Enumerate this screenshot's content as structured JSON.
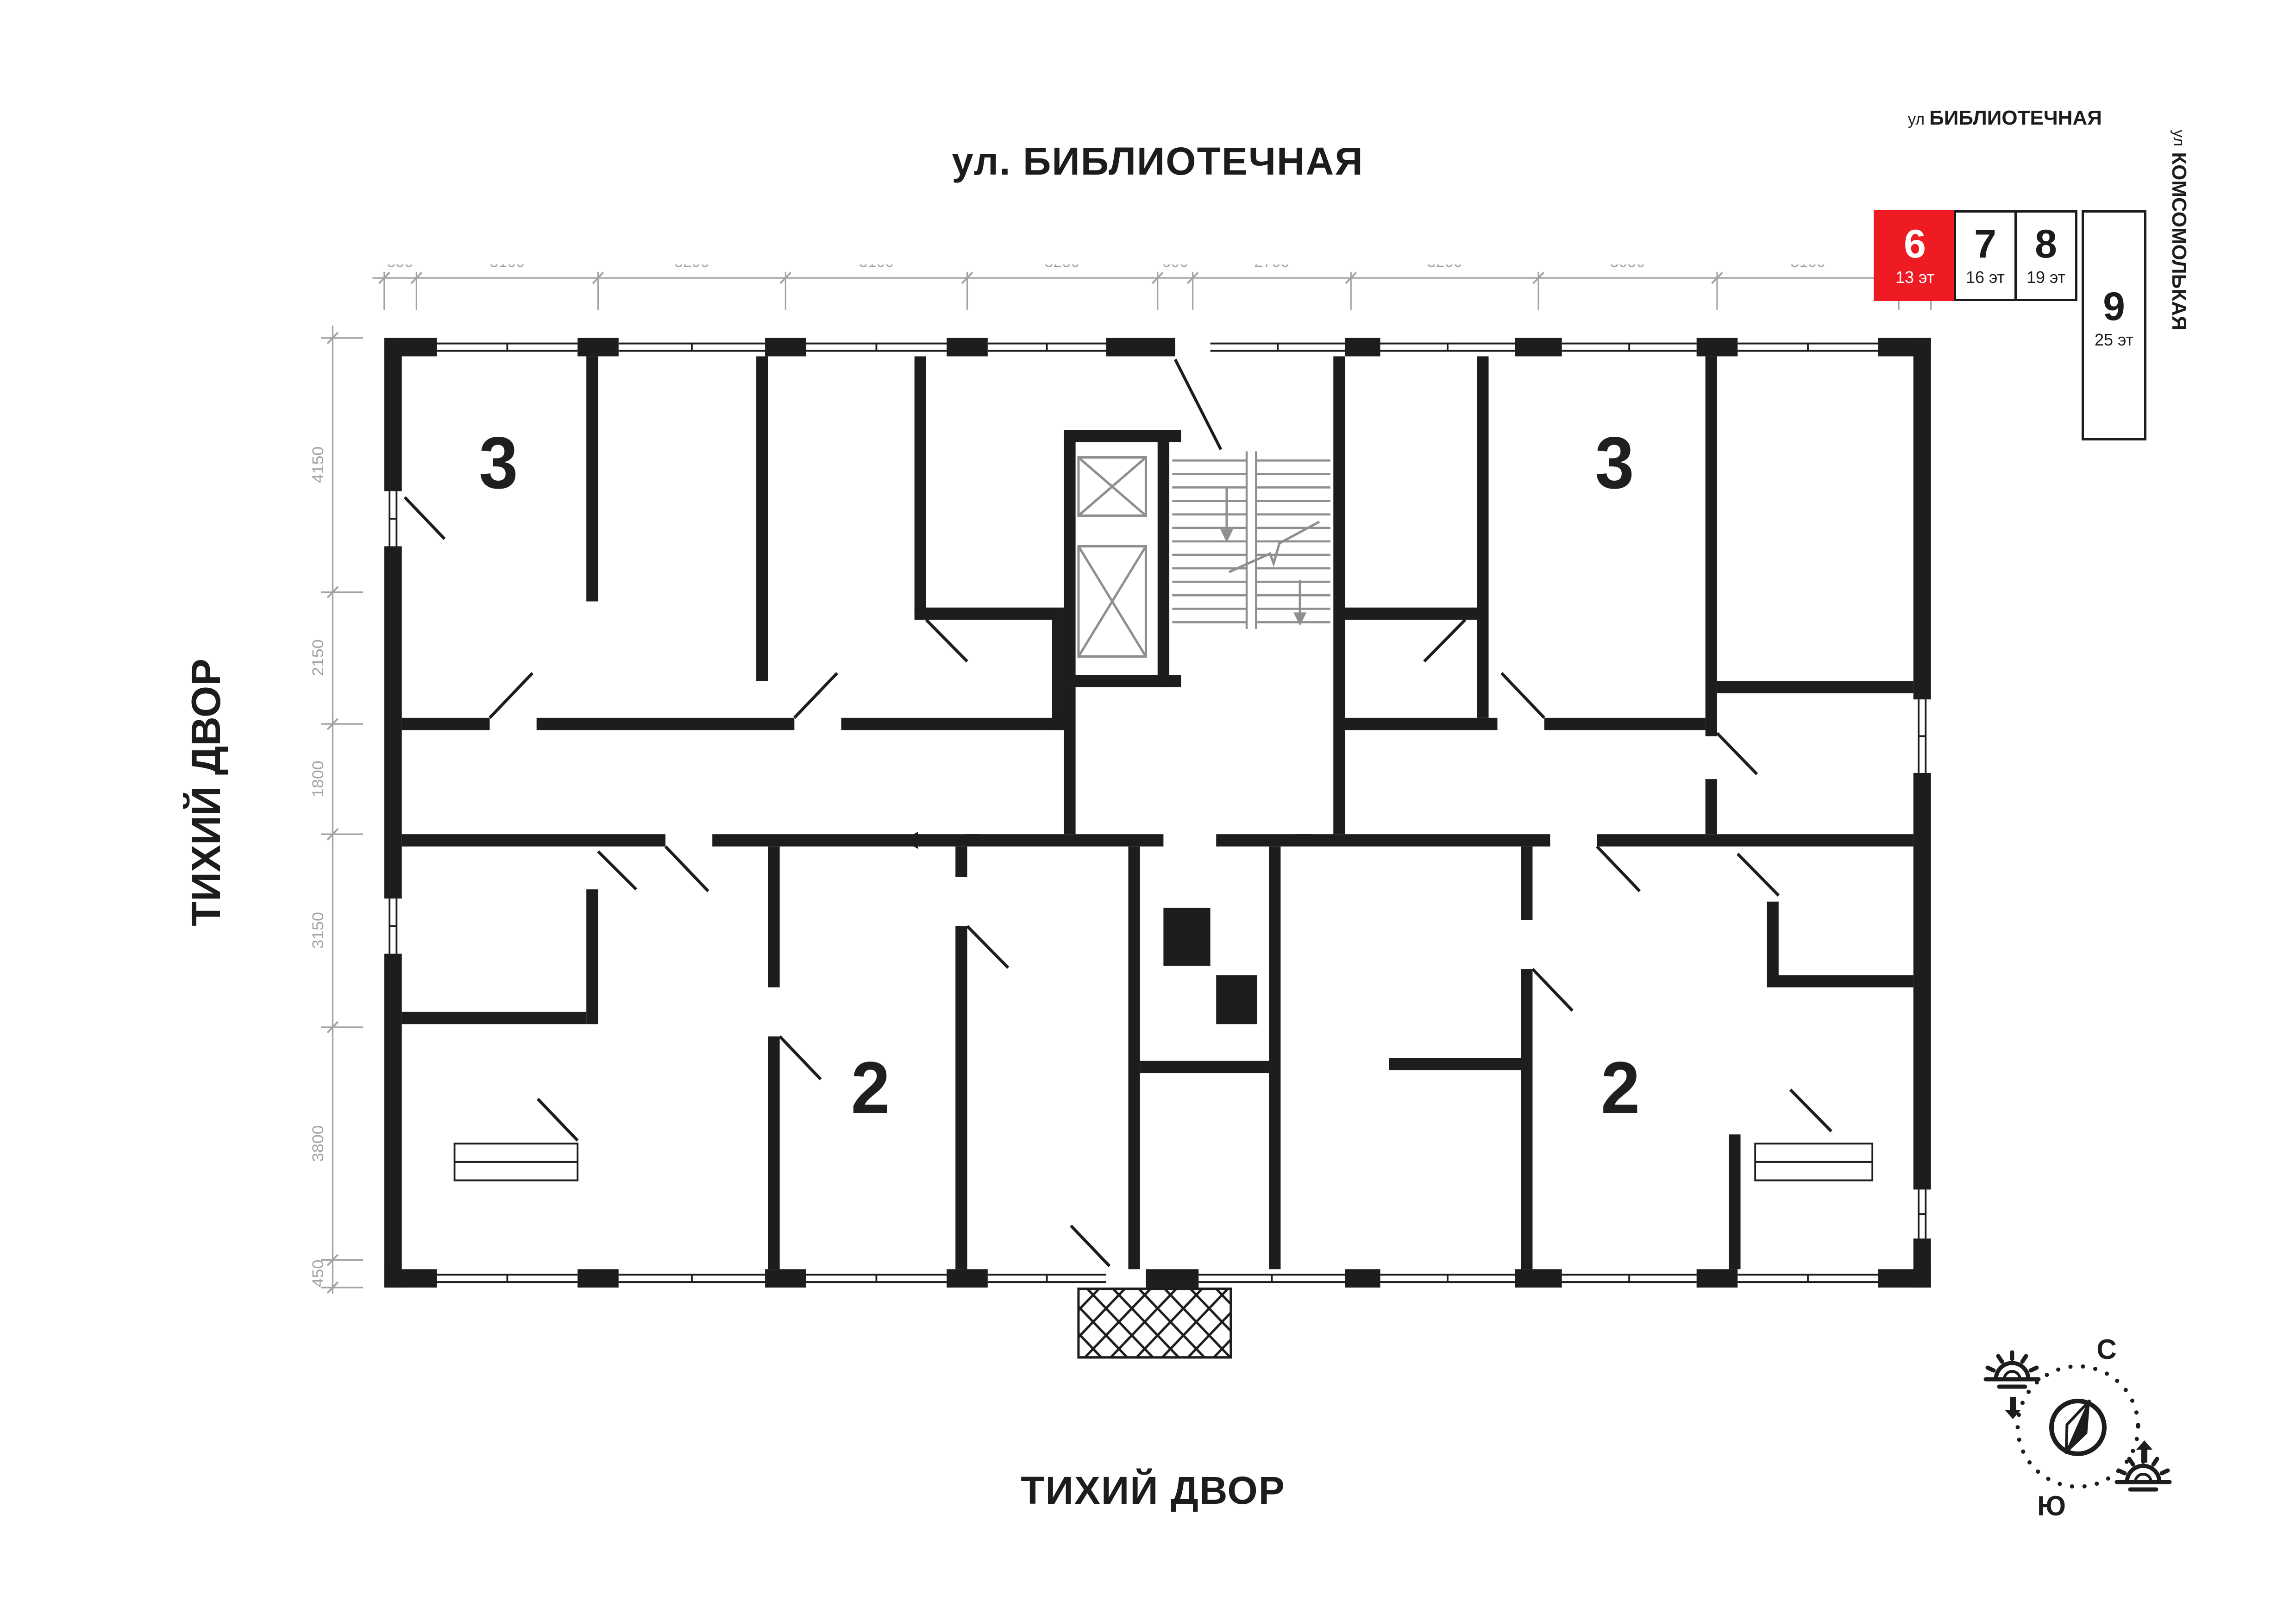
{
  "streets": {
    "top": "ул. БИБЛИОТЕЧНАЯ",
    "bottom": "ТИХИЙ ДВОР",
    "left": "ТИХИЙ ДВОР"
  },
  "plan": {
    "dims_top": [
      "550",
      "3100",
      "3200",
      "3100",
      "3250",
      "600",
      "2700",
      "3200",
      "3050",
      "3100",
      "550"
    ],
    "dims_left": [
      "4150",
      "2150",
      "1800",
      "3150",
      "3800",
      "450"
    ],
    "rooms": [
      {
        "id": "apt-3-left",
        "label": "3"
      },
      {
        "id": "apt-3-right",
        "label": "3"
      },
      {
        "id": "apt-2-left",
        "label": "2"
      },
      {
        "id": "apt-2-right",
        "label": "2"
      }
    ]
  },
  "minimap": {
    "street_top_prefix": "ул",
    "street_top": "БИБЛИОТЕЧНАЯ",
    "street_right_prefix": "ул",
    "street_right": "КОМСОМОЛЬКАЯ",
    "blocks": [
      {
        "num": "6",
        "floors": "13 эт",
        "active": true
      },
      {
        "num": "7",
        "floors": "16 эт",
        "active": false
      },
      {
        "num": "8",
        "floors": "19 эт",
        "active": false
      },
      {
        "num": "9",
        "floors": "25 эт",
        "active": false
      }
    ]
  },
  "compass": {
    "north": "С",
    "south": "Ю"
  },
  "colors": {
    "accent": "#ee1b23",
    "wall": "#1d1d1d",
    "dim": "#a3a3a3"
  }
}
